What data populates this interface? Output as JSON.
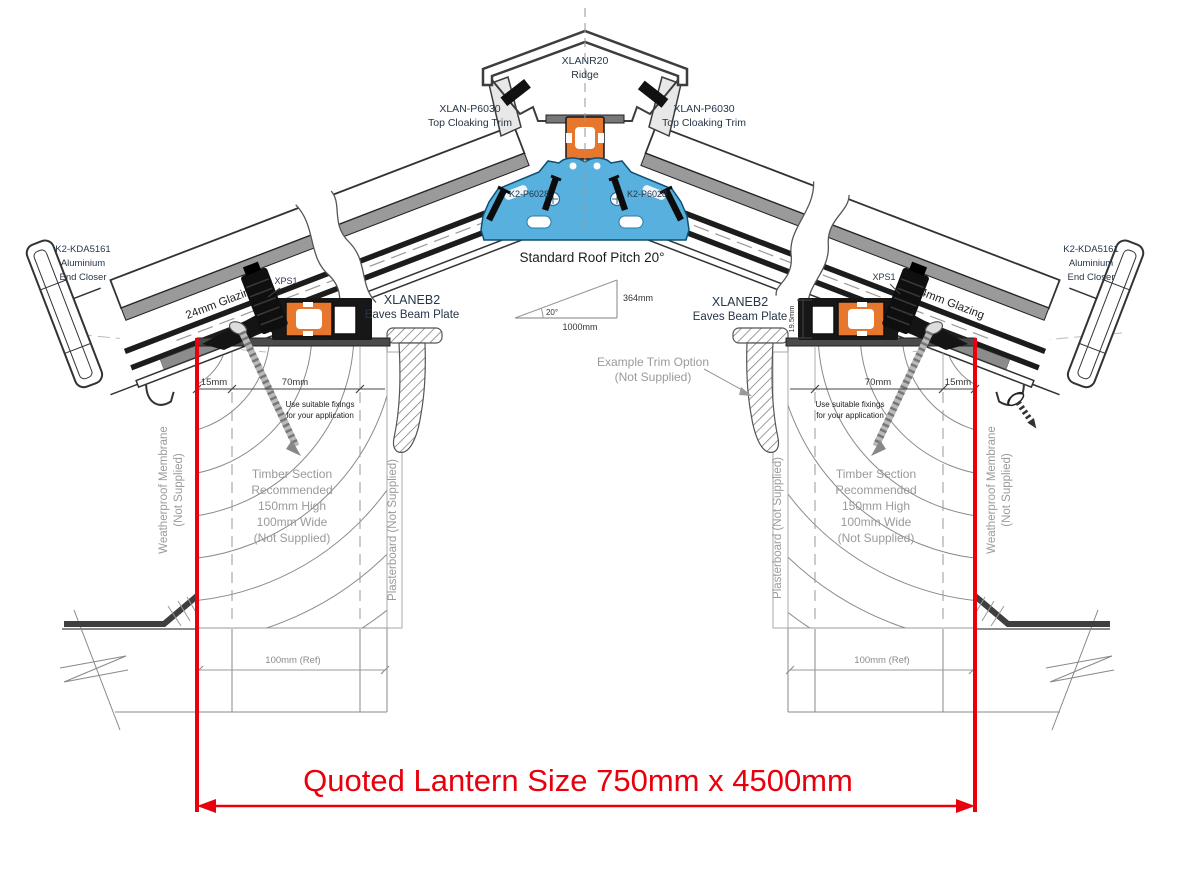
{
  "drawing": {
    "quoted_size": "Quoted Lantern Size 750mm x 4500mm",
    "ridge": {
      "code": "XLANR20",
      "name": "Ridge"
    },
    "top_cloaking_trim": {
      "code": "XLAN-P6030",
      "name": "Top Cloaking Trim"
    },
    "ridge_fixing_code": "K2-P6028",
    "end_closer": {
      "code": "K2-KDA5161",
      "line2": "Aluminium",
      "line3": "End Closer"
    },
    "glazing_label": "24mm Glazing",
    "pitch": {
      "title": "Standard Roof Pitch 20°",
      "angle": "20°",
      "run": "1000mm",
      "rise": "364mm"
    },
    "eaves_beam": {
      "code": "XLANEB2",
      "name": "Eaves Beam Plate"
    },
    "glass_clamp_code": "XPS1",
    "dims": {
      "edge": "15mm",
      "fixing_zone": "70mm",
      "beam_height": "19.5mm",
      "wall_ref": "100mm (Ref)"
    },
    "fixing_note": {
      "line1": "Use suitable fixings",
      "line2": "for your application"
    },
    "timber_note": {
      "line1": "Timber Section",
      "line2": "Recommended",
      "line3": "150mm High",
      "line4": "100mm Wide",
      "line5": "(Not Supplied)"
    },
    "membrane_note": {
      "line1": "Weatherproof Membrane",
      "line2": "(Not Supplied)"
    },
    "plasterboard_note": "Plasterboard (Not Supplied)",
    "trim_option_note": {
      "line1": "Example Trim Option",
      "line2": "(Not Supplied)"
    },
    "colors": {
      "accent_red": "#e8000d",
      "profile_orange": "#e8772e",
      "thermal_blue": "#57b0dd",
      "code_text": "#253649",
      "note_gray": "#9a9a9a"
    }
  }
}
